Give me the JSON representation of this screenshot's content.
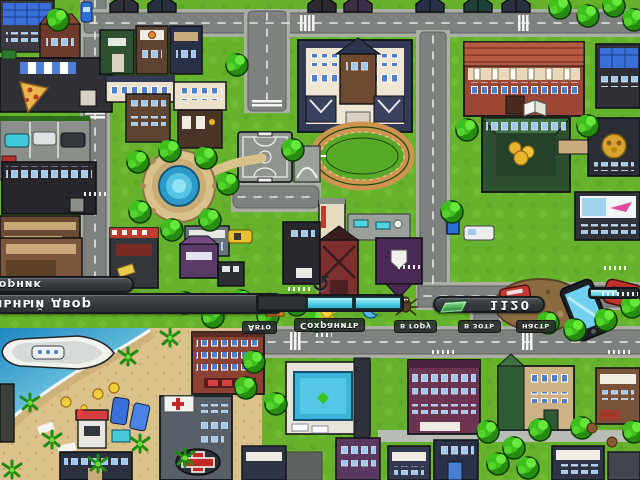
{
  "hud": {
    "npc_name": "Дворник",
    "location": "Школьный двор",
    "money": "1120",
    "refresh_glyph": "↺",
    "menu_row": [
      "Авто",
      "Сохранить",
      "в гору",
      "в зоть",
      "насть"
    ],
    "icons": {
      "money": "cash-icon",
      "refresh": "refresh-arrow-icon",
      "day_cycle": [
        "sunset-icon",
        "sun-icon",
        "moon-icon",
        "spider-icon"
      ]
    },
    "day_cycle": {
      "segments_total": 3,
      "segments_filled": 2
    }
  },
  "colors": {
    "grass": "#66b22d",
    "road": "#7e827e",
    "sand": "#dbc28b",
    "water": "#2f9fd1",
    "hud_bar": "#383d41",
    "hud_text": "#f4f6f7",
    "progress_cyan": "#49ccdf",
    "money_green": "#3aa04a",
    "tree_green": "#3fbf1e"
  },
  "landmarks": [
    "pizza-shop",
    "parking-lot",
    "school-campus",
    "basketball-court",
    "fountain-plaza",
    "running-track",
    "red-mansion",
    "bank",
    "beach",
    "yacht",
    "hospital",
    "brick-apartment",
    "swimming-pool",
    "purple-apartment",
    "smartphone-prop",
    "dirt-playground"
  ]
}
